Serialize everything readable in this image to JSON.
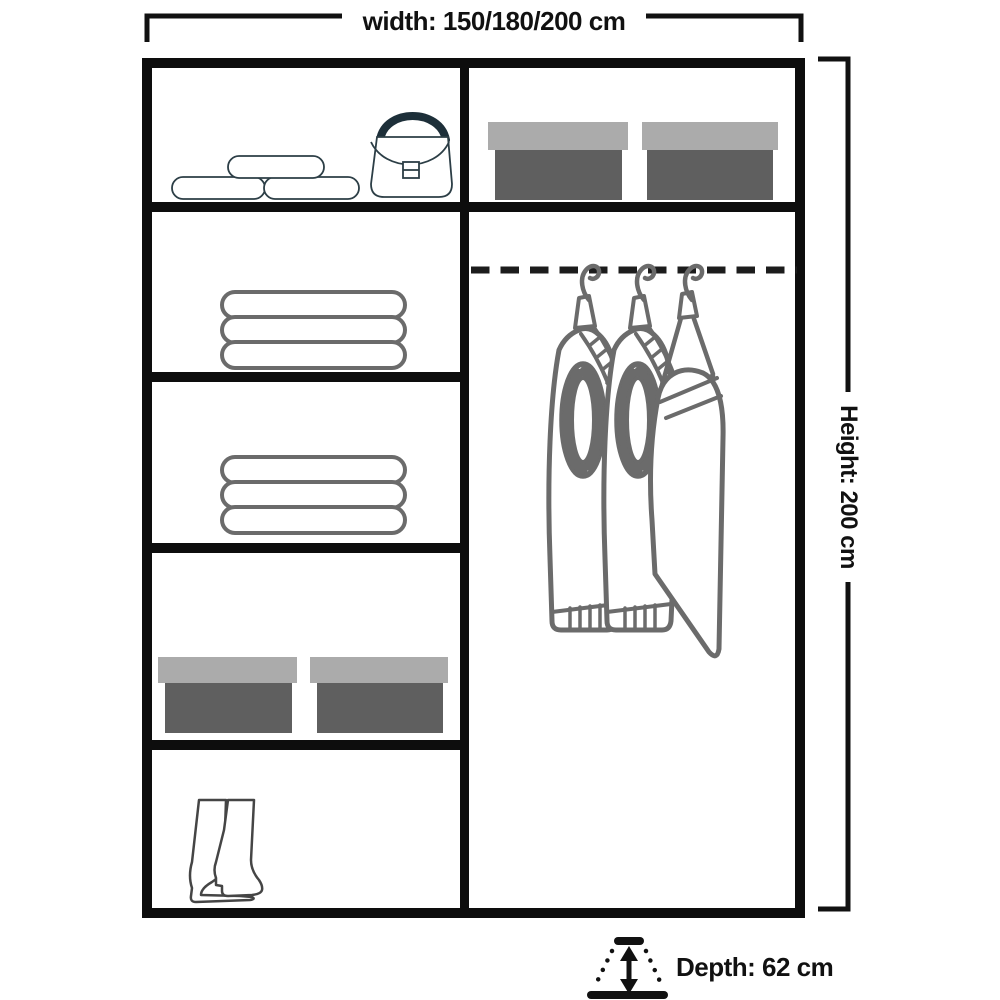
{
  "labels": {
    "width": "width: 150/180/200 cm",
    "height": "Height: 200 cm",
    "depth": "Depth: 62 cm"
  },
  "colors": {
    "ink": "#111111",
    "frame": "#0d0d0d",
    "bag_stroke": "#2c3e46",
    "soft_gray": "#6b6b6b",
    "boot_gray": "#454545",
    "box_lid": "#ababab",
    "box_body": "#5f5f5f",
    "background": "#ffffff"
  },
  "wardrobe": {
    "columns": 2,
    "left_column": {
      "shelf_count": 5,
      "shelves": [
        {
          "name": "shelf-1",
          "contents": [
            "pillows-icon",
            "handbag-icon"
          ]
        },
        {
          "name": "shelf-2",
          "contents": [
            "towel-stack-icon"
          ]
        },
        {
          "name": "shelf-3",
          "contents": [
            "towel-stack-icon"
          ]
        },
        {
          "name": "shelf-4",
          "contents": [
            "shoe-box-icon",
            "shoe-box-icon"
          ]
        },
        {
          "name": "shelf-5",
          "contents": [
            "boots-icon"
          ]
        }
      ]
    },
    "right_column": {
      "shelf_count": 2,
      "shelves": [
        {
          "name": "top-shelf",
          "contents": [
            "shoe-box-icon",
            "shoe-box-icon"
          ]
        },
        {
          "name": "hanging-section",
          "contents": [
            "hanging-rail",
            "jeans-icon",
            "jeans-icon",
            "trousers-icon"
          ]
        }
      ]
    }
  },
  "depth_icon": "depth-arrow-icon"
}
